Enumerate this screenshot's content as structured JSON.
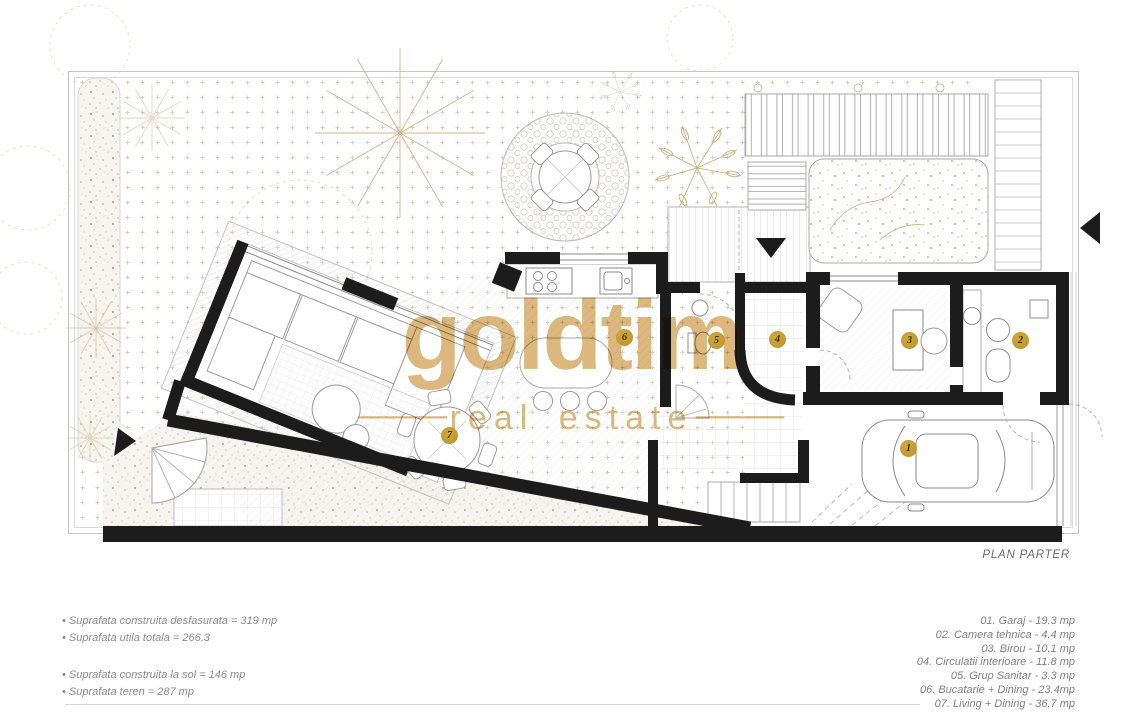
{
  "watermark": {
    "brand": "goldtim",
    "dash": "—",
    "tagline": "real estate",
    "color": "#dcb87e"
  },
  "plan": {
    "title": "PLAN PARTER",
    "marker_color": "#bf9a2f",
    "rooms": [
      {
        "number": "1",
        "name": "Garaj",
        "area": "19.3 mp"
      },
      {
        "number": "2",
        "name": "Camera tehnica",
        "area": "4.4 mp"
      },
      {
        "number": "3",
        "name": "Birou",
        "area": "10.1 mp"
      },
      {
        "number": "4",
        "name": "Circulatii interioare",
        "area": "11.8 mp"
      },
      {
        "number": "5",
        "name": "Grup Sanitar",
        "area": "3.3 mp"
      },
      {
        "number": "6",
        "name": "Bucatarie + Dining",
        "area": "23.4mp"
      },
      {
        "number": "7",
        "name": "Living + Dining",
        "area": "36.7 mp"
      }
    ]
  },
  "summary": {
    "block1": [
      "• Suprafata construita desfasurata = 319 mp",
      "• Suprafata utila totala = 266.3"
    ],
    "block2": [
      "• Suprafata construita la sol = 146 mp",
      "• Suprafata teren = 287 mp"
    ]
  },
  "legend": {
    "items": [
      "01. Garaj - 19.3 mp",
      "02. Camera tehnica - 4.4 mp",
      "03. Birou - 10.1 mp",
      "04. Circulatii interioare - 11.8 mp",
      "05. Grup Sanitar - 3.3 mp",
      "06. Bucatarie + Dining - 23.4mp",
      "07. Living + Dining - 36.7 mp"
    ]
  }
}
